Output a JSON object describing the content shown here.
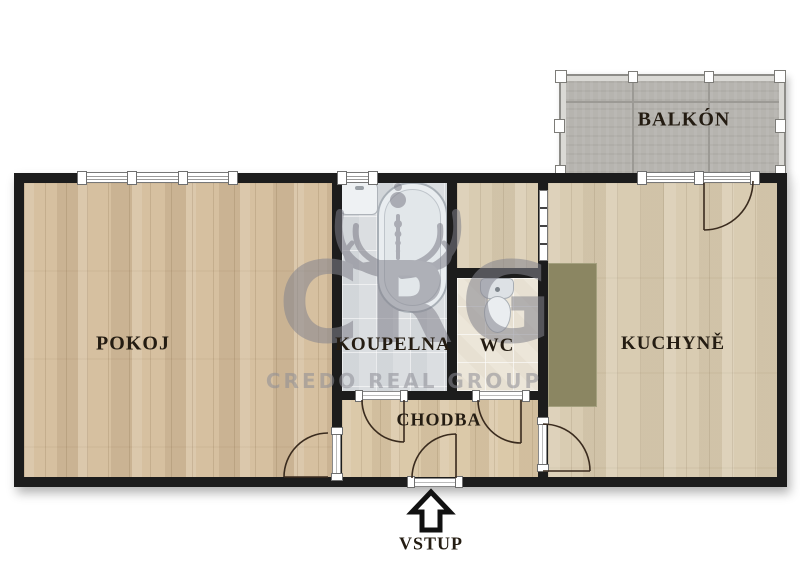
{
  "floorplan": {
    "title": "Apartment floor plan",
    "rooms": [
      {
        "id": "pokoj",
        "label": "POKOJ"
      },
      {
        "id": "koupelna",
        "label": "KOUPELNA"
      },
      {
        "id": "wc",
        "label": "WC"
      },
      {
        "id": "kuchyne",
        "label": "KUCHYNĚ"
      },
      {
        "id": "chodba",
        "label": "CHODBA"
      },
      {
        "id": "balkon",
        "label": "BALKÓN"
      }
    ],
    "entrance": {
      "label": "VSTUP",
      "direction": "up"
    },
    "watermark": {
      "logo": "CRG",
      "company": "CREDO REAL GROUP"
    },
    "fixtures": [
      "bathtub",
      "sink",
      "toilet",
      "kitchen-counter"
    ],
    "colors": {
      "wall": "#1c1c1c",
      "wood_room": "#d6c0a0",
      "wood_kitchen": "#d9ccb2",
      "tile_bath": "#dbdee1",
      "tile_wc": "#ece6d9",
      "balcony_floor": "#b6b4af",
      "counter_olive": "#8b8662",
      "watermark_gray": "#84848e",
      "label_text": "#241c12"
    }
  }
}
